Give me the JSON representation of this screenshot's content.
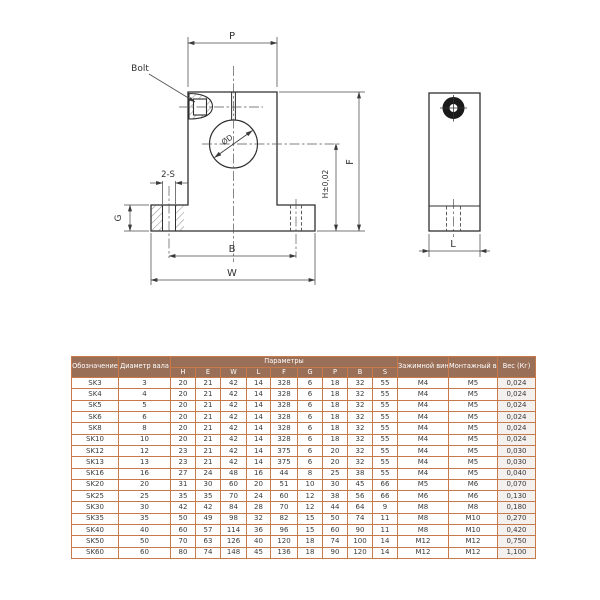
{
  "drawing": {
    "labels": {
      "p": "P",
      "bolt": "Bolt",
      "diameter": "ØD",
      "slot": "2-S",
      "g": "G",
      "b": "B",
      "w": "W",
      "f": "F",
      "h_tol": "H±0,02",
      "l": "L"
    },
    "line_color": "#2f2f2f"
  },
  "table": {
    "colors": {
      "header_bg": "#9a6f58",
      "header_text": "#ffffff",
      "border": "#c8794a",
      "cell_text": "#3a3a3a"
    },
    "header": {
      "designation": "Обозначение",
      "shaft_diameter": "Диаметр вала",
      "parameters": "Параметры",
      "param_cols": [
        "H",
        "E",
        "W",
        "L",
        "F",
        "G",
        "P",
        "B",
        "S"
      ],
      "clamp_screw": "Зажимной винт",
      "mount_screw": "Монтажный винт",
      "weight": "Вес (Кг)"
    },
    "rows": [
      {
        "name": "SK3",
        "dia": "3",
        "vals": [
          "20",
          "21",
          "42",
          "14",
          "328",
          "6",
          "18",
          "32",
          "55"
        ],
        "clamp": "M4",
        "mount": "M5",
        "weight": "0,024"
      },
      {
        "name": "SK4",
        "dia": "4",
        "vals": [
          "20",
          "21",
          "42",
          "14",
          "328",
          "6",
          "18",
          "32",
          "55"
        ],
        "clamp": "M4",
        "mount": "M5",
        "weight": "0,024"
      },
      {
        "name": "SK5",
        "dia": "5",
        "vals": [
          "20",
          "21",
          "42",
          "14",
          "328",
          "6",
          "18",
          "32",
          "55"
        ],
        "clamp": "M4",
        "mount": "M5",
        "weight": "0,024"
      },
      {
        "name": "SK6",
        "dia": "6",
        "vals": [
          "20",
          "21",
          "42",
          "14",
          "328",
          "6",
          "18",
          "32",
          "55"
        ],
        "clamp": "M4",
        "mount": "M5",
        "weight": "0,024"
      },
      {
        "name": "SK8",
        "dia": "8",
        "vals": [
          "20",
          "21",
          "42",
          "14",
          "328",
          "6",
          "18",
          "32",
          "55"
        ],
        "clamp": "M4",
        "mount": "M5",
        "weight": "0,024"
      },
      {
        "name": "SK10",
        "dia": "10",
        "vals": [
          "20",
          "21",
          "42",
          "14",
          "328",
          "6",
          "18",
          "32",
          "55"
        ],
        "clamp": "M4",
        "mount": "M5",
        "weight": "0,024"
      },
      {
        "name": "SK12",
        "dia": "12",
        "vals": [
          "23",
          "21",
          "42",
          "14",
          "375",
          "6",
          "20",
          "32",
          "55"
        ],
        "clamp": "M4",
        "mount": "M5",
        "weight": "0,030"
      },
      {
        "name": "SK13",
        "dia": "13",
        "vals": [
          "23",
          "21",
          "42",
          "14",
          "375",
          "6",
          "20",
          "32",
          "55"
        ],
        "clamp": "M4",
        "mount": "M5",
        "weight": "0,030"
      },
      {
        "name": "SK16",
        "dia": "16",
        "vals": [
          "27",
          "24",
          "48",
          "16",
          "44",
          "8",
          "25",
          "38",
          "55"
        ],
        "clamp": "M4",
        "mount": "M5",
        "weight": "0,040"
      },
      {
        "name": "SK20",
        "dia": "20",
        "vals": [
          "31",
          "30",
          "60",
          "20",
          "51",
          "10",
          "30",
          "45",
          "66"
        ],
        "clamp": "M5",
        "mount": "M6",
        "weight": "0,070"
      },
      {
        "name": "SK25",
        "dia": "25",
        "vals": [
          "35",
          "35",
          "70",
          "24",
          "60",
          "12",
          "38",
          "56",
          "66"
        ],
        "clamp": "M6",
        "mount": "M6",
        "weight": "0,130"
      },
      {
        "name": "SK30",
        "dia": "30",
        "vals": [
          "42",
          "42",
          "84",
          "28",
          "70",
          "12",
          "44",
          "64",
          "9"
        ],
        "clamp": "M8",
        "mount": "M8",
        "weight": "0,180"
      },
      {
        "name": "SK35",
        "dia": "35",
        "vals": [
          "50",
          "49",
          "98",
          "32",
          "82",
          "15",
          "50",
          "74",
          "11"
        ],
        "clamp": "M8",
        "mount": "M10",
        "weight": "0,270"
      },
      {
        "name": "SK40",
        "dia": "40",
        "vals": [
          "60",
          "57",
          "114",
          "36",
          "96",
          "15",
          "60",
          "90",
          "11"
        ],
        "clamp": "M8",
        "mount": "M10",
        "weight": "0,420"
      },
      {
        "name": "SK50",
        "dia": "50",
        "vals": [
          "70",
          "63",
          "126",
          "40",
          "120",
          "18",
          "74",
          "100",
          "14"
        ],
        "clamp": "M12",
        "mount": "M12",
        "weight": "0,750"
      },
      {
        "name": "SK60",
        "dia": "60",
        "vals": [
          "80",
          "74",
          "148",
          "45",
          "136",
          "18",
          "90",
          "120",
          "14"
        ],
        "clamp": "M12",
        "mount": "M12",
        "weight": "1,100"
      }
    ]
  }
}
